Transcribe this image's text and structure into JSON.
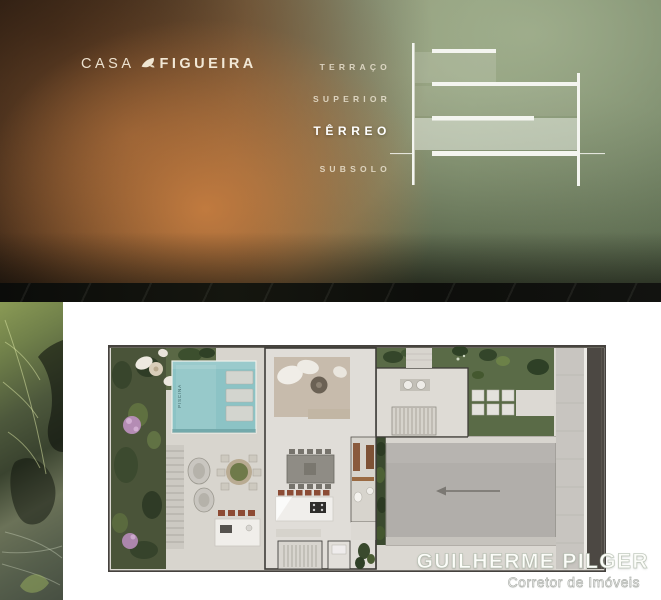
{
  "hero": {
    "title": {
      "casa": "CASA",
      "figueira": "FIGUEIRA"
    },
    "levels": [
      {
        "label": "TERRAÇO",
        "active": false
      },
      {
        "label": "SUPERIOR",
        "active": false
      },
      {
        "label": "TÊRREO",
        "active": true
      },
      {
        "label": "SUBSOLO",
        "active": false
      }
    ],
    "diagram": {
      "type": "building-section-schematic",
      "floors": [
        "TERRAÇO",
        "SUPERIOR",
        "TÊRREO",
        "SUBSOLO"
      ],
      "highlighted_floor": "TÊRREO"
    }
  },
  "floorplan": {
    "pool_label": "PISCINA"
  },
  "attribution": {
    "name": "GUILHERME PILGER",
    "subtitle": "Corretor de Imóveis"
  },
  "colors": {
    "cream_text": "#f2e8d6",
    "active_level": "#ffffff",
    "pool": "#8cc3c5",
    "hero_green": "#83936f",
    "hero_orange": "#a87e4f",
    "divider": "#0d0e0b"
  }
}
